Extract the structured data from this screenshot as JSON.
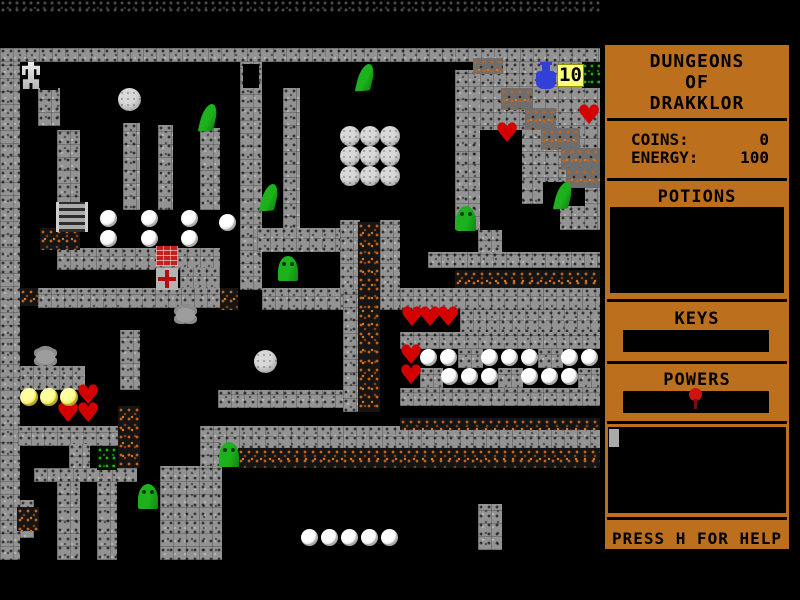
{
  "game": {
    "title": "DUNGEONS OF DRAKKLOR"
  },
  "sidebar": {
    "title_lines": [
      "DUNGEONS",
      "OF",
      "DRAKKLOR"
    ],
    "coins_label": "COINS:",
    "coins_value": "0",
    "energy_label": "ENERGY:",
    "energy_value": "100",
    "potions_label": "POTIONS",
    "keys_label": "KEYS",
    "powers_label": "POWERS",
    "help_text": "PRESS H FOR HELP"
  },
  "hud": {
    "potion_count": "10"
  },
  "colors": {
    "sidebar_accent": "#bc6f1d",
    "wall_gray": "#939393",
    "dirt_orange": "#c4641c",
    "slime_green": "#1db21d",
    "heart_red": "#d40000",
    "flask_blue": "#3240d8",
    "badge_yellow": "#ffff7d"
  },
  "map": {
    "dark_rubble": [
      [
        0,
        0,
        600,
        13
      ]
    ],
    "walls": [
      [
        0,
        48,
        600,
        14
      ],
      [
        0,
        62,
        20,
        498
      ],
      [
        38,
        88,
        22,
        38
      ],
      [
        57,
        130,
        23,
        80
      ],
      [
        123,
        123,
        17,
        87
      ],
      [
        158,
        125,
        15,
        85
      ],
      [
        200,
        128,
        20,
        82
      ],
      [
        240,
        62,
        22,
        228
      ],
      [
        283,
        88,
        17,
        142
      ],
      [
        455,
        70,
        25,
        160
      ],
      [
        478,
        228,
        24,
        26
      ],
      [
        480,
        62,
        120,
        168
      ],
      [
        428,
        252,
        172,
        16
      ],
      [
        57,
        248,
        163,
        22
      ],
      [
        180,
        268,
        40,
        22
      ],
      [
        38,
        288,
        182,
        20
      ],
      [
        257,
        228,
        103,
        24
      ],
      [
        340,
        220,
        20,
        70
      ],
      [
        380,
        220,
        20,
        70
      ],
      [
        262,
        288,
        93,
        22
      ],
      [
        343,
        290,
        17,
        122
      ],
      [
        380,
        288,
        20,
        22
      ],
      [
        400,
        288,
        200,
        22
      ],
      [
        460,
        310,
        140,
        24
      ],
      [
        400,
        332,
        200,
        17
      ],
      [
        458,
        349,
        25,
        19
      ],
      [
        538,
        349,
        25,
        19
      ],
      [
        420,
        368,
        23,
        20
      ],
      [
        498,
        368,
        25,
        20
      ],
      [
        578,
        368,
        22,
        20
      ],
      [
        400,
        388,
        200,
        18
      ],
      [
        218,
        390,
        125,
        18
      ],
      [
        200,
        426,
        400,
        24
      ],
      [
        200,
        426,
        20,
        134
      ],
      [
        478,
        504,
        24,
        46
      ],
      [
        20,
        366,
        65,
        24
      ],
      [
        120,
        330,
        20,
        60
      ],
      [
        18,
        426,
        102,
        20
      ],
      [
        69,
        444,
        21,
        26
      ],
      [
        34,
        468,
        103,
        14
      ],
      [
        57,
        482,
        23,
        78
      ],
      [
        97,
        482,
        20,
        78
      ],
      [
        160,
        466,
        62,
        94
      ],
      [
        20,
        500,
        14,
        38
      ]
    ],
    "door_gaps": [
      [
        40,
        62,
        18,
        28
      ],
      [
        243,
        64,
        16,
        24
      ],
      [
        480,
        130,
        42,
        100
      ],
      [
        502,
        204,
        58,
        26
      ],
      [
        543,
        182,
        42,
        24
      ]
    ],
    "dirt_floor": [
      [
        358,
        222,
        22,
        190
      ],
      [
        238,
        448,
        362,
        20
      ],
      [
        400,
        418,
        200,
        12
      ],
      [
        118,
        406,
        22,
        62
      ],
      [
        20,
        288,
        18,
        18
      ],
      [
        40,
        228,
        40,
        22
      ],
      [
        17,
        507,
        22,
        24
      ],
      [
        220,
        288,
        18,
        22
      ],
      [
        455,
        270,
        145,
        18
      ]
    ],
    "dirt_wall": [
      [
        473,
        58,
        30,
        16
      ],
      [
        501,
        88,
        32,
        22
      ],
      [
        525,
        108,
        31,
        22
      ],
      [
        541,
        128,
        39,
        22
      ],
      [
        561,
        148,
        39,
        22
      ],
      [
        566,
        168,
        34,
        20
      ]
    ],
    "green_dirt": [
      [
        582,
        62,
        18,
        26
      ],
      [
        97,
        446,
        20,
        24
      ]
    ]
  },
  "sprites": [
    {
      "t": "robot",
      "x": 22,
      "y": 62
    },
    {
      "t": "ladder",
      "x": 56,
      "y": 202
    },
    {
      "t": "gball",
      "x": 118,
      "y": 88
    },
    {
      "t": "gball",
      "x": 254,
      "y": 350
    },
    {
      "t": "gballs",
      "x": 340,
      "y": 126
    },
    {
      "t": "gballs",
      "x": 360,
      "y": 126
    },
    {
      "t": "gballs",
      "x": 380,
      "y": 126
    },
    {
      "t": "gballs",
      "x": 340,
      "y": 146
    },
    {
      "t": "gballs",
      "x": 360,
      "y": 146
    },
    {
      "t": "gballs",
      "x": 380,
      "y": 146
    },
    {
      "t": "gballs",
      "x": 340,
      "y": 166
    },
    {
      "t": "gballs",
      "x": 360,
      "y": 166
    },
    {
      "t": "gballs",
      "x": 380,
      "y": 166
    },
    {
      "t": "slime-lean",
      "x": 201,
      "y": 104
    },
    {
      "t": "slime-lean",
      "x": 358,
      "y": 64
    },
    {
      "t": "slime-lean",
      "x": 262,
      "y": 184
    },
    {
      "t": "slime-lean",
      "x": 556,
      "y": 182
    },
    {
      "t": "slime-up",
      "x": 278,
      "y": 256
    },
    {
      "t": "slime-up",
      "x": 456,
      "y": 206
    },
    {
      "t": "slime-up",
      "x": 138,
      "y": 484
    },
    {
      "t": "slime-up",
      "x": 219,
      "y": 442
    },
    {
      "t": "heart",
      "x": 495,
      "y": 124
    },
    {
      "t": "heart",
      "x": 577,
      "y": 106
    },
    {
      "t": "heart",
      "x": 400,
      "y": 308
    },
    {
      "t": "heart",
      "x": 418,
      "y": 308
    },
    {
      "t": "heart",
      "x": 436,
      "y": 308
    },
    {
      "t": "heart",
      "x": 399,
      "y": 346
    },
    {
      "t": "heart",
      "x": 399,
      "y": 366
    },
    {
      "t": "heart",
      "x": 76,
      "y": 386
    },
    {
      "t": "heart",
      "x": 56,
      "y": 404
    },
    {
      "t": "heart",
      "x": 76,
      "y": 404
    },
    {
      "t": "pearl",
      "x": 100,
      "y": 210
    },
    {
      "t": "pearl",
      "x": 141,
      "y": 210
    },
    {
      "t": "pearl",
      "x": 181,
      "y": 210
    },
    {
      "t": "pearl",
      "x": 219,
      "y": 214
    },
    {
      "t": "pearl",
      "x": 100,
      "y": 230
    },
    {
      "t": "pearl",
      "x": 141,
      "y": 230
    },
    {
      "t": "pearl",
      "x": 181,
      "y": 230
    },
    {
      "t": "pearl",
      "x": 420,
      "y": 349
    },
    {
      "t": "pearl",
      "x": 440,
      "y": 349
    },
    {
      "t": "pearl",
      "x": 481,
      "y": 349
    },
    {
      "t": "pearl",
      "x": 501,
      "y": 349
    },
    {
      "t": "pearl",
      "x": 521,
      "y": 349
    },
    {
      "t": "pearl",
      "x": 561,
      "y": 349
    },
    {
      "t": "pearl",
      "x": 581,
      "y": 349
    },
    {
      "t": "pearl",
      "x": 441,
      "y": 368
    },
    {
      "t": "pearl",
      "x": 461,
      "y": 368
    },
    {
      "t": "pearl",
      "x": 481,
      "y": 368
    },
    {
      "t": "pearl",
      "x": 521,
      "y": 368
    },
    {
      "t": "pearl",
      "x": 541,
      "y": 368
    },
    {
      "t": "pearl",
      "x": 561,
      "y": 368
    },
    {
      "t": "pearl",
      "x": 301,
      "y": 529
    },
    {
      "t": "pearl",
      "x": 321,
      "y": 529
    },
    {
      "t": "pearl",
      "x": 341,
      "y": 529
    },
    {
      "t": "pearl",
      "x": 361,
      "y": 529
    },
    {
      "t": "pearl",
      "x": 381,
      "y": 529
    },
    {
      "t": "ypearl",
      "x": 20,
      "y": 388
    },
    {
      "t": "ypearl",
      "x": 40,
      "y": 388
    },
    {
      "t": "ypearl",
      "x": 60,
      "y": 388
    },
    {
      "t": "bug",
      "x": 176,
      "y": 308
    },
    {
      "t": "bug",
      "x": 36,
      "y": 350
    },
    {
      "t": "brick",
      "x": 156,
      "y": 246
    },
    {
      "t": "cross",
      "x": 156,
      "y": 268
    },
    {
      "t": "flask",
      "x": 536,
      "y": 62
    },
    {
      "t": "badge",
      "x": 557,
      "y": 64
    }
  ]
}
